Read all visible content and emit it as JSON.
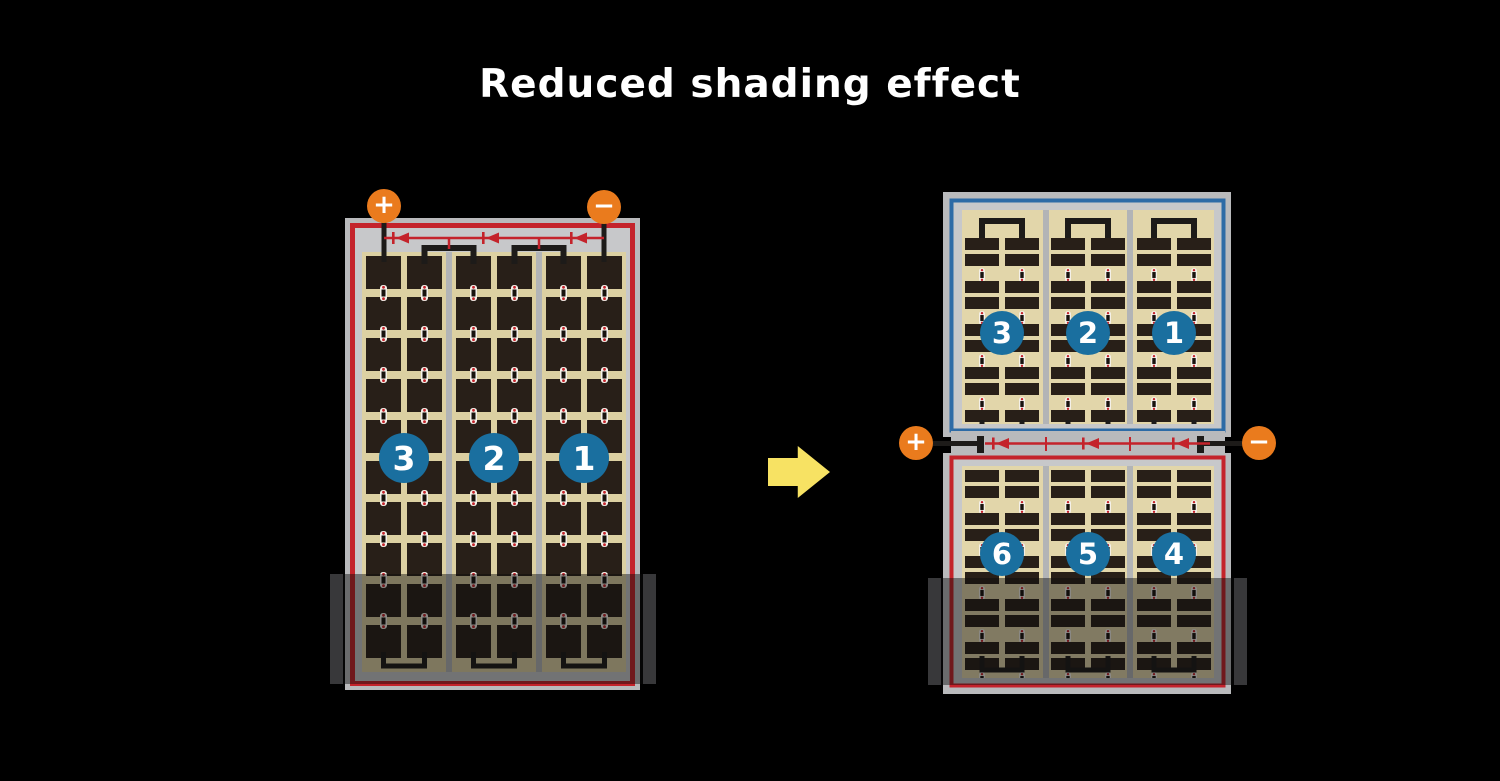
{
  "title": "Reduced shading effect",
  "left_module": {
    "terminals": {
      "positive": "+",
      "negative": "−"
    },
    "cell_strings": [
      {
        "label": "3"
      },
      {
        "label": "2"
      },
      {
        "label": "1"
      }
    ],
    "bypass_diode_count": 3
  },
  "right_module": {
    "terminals": {
      "positive": "+",
      "negative": "−"
    },
    "top_half_strings": [
      {
        "label": "3"
      },
      {
        "label": "2"
      },
      {
        "label": "1"
      }
    ],
    "bottom_half_strings": [
      {
        "label": "6"
      },
      {
        "label": "5"
      },
      {
        "label": "4"
      }
    ],
    "bypass_diode_count": 3
  },
  "arrow": {
    "direction": "right"
  },
  "colors": {
    "background": "#000000",
    "frame": "#b9babc",
    "inner": "#c7c8ca",
    "tan": "#dcd0a2",
    "tan2": "#e2d6aa",
    "separator": "#b2b4b6",
    "cell": "#281f18",
    "black": "#1d1b19",
    "red": "#c4232b",
    "blue": "#2d6ba6",
    "circle_blue": "#1a6f9f",
    "orange": "#ea7b1d",
    "arrow_yellow": "#f7e263",
    "shade_cap": "#38383a"
  }
}
